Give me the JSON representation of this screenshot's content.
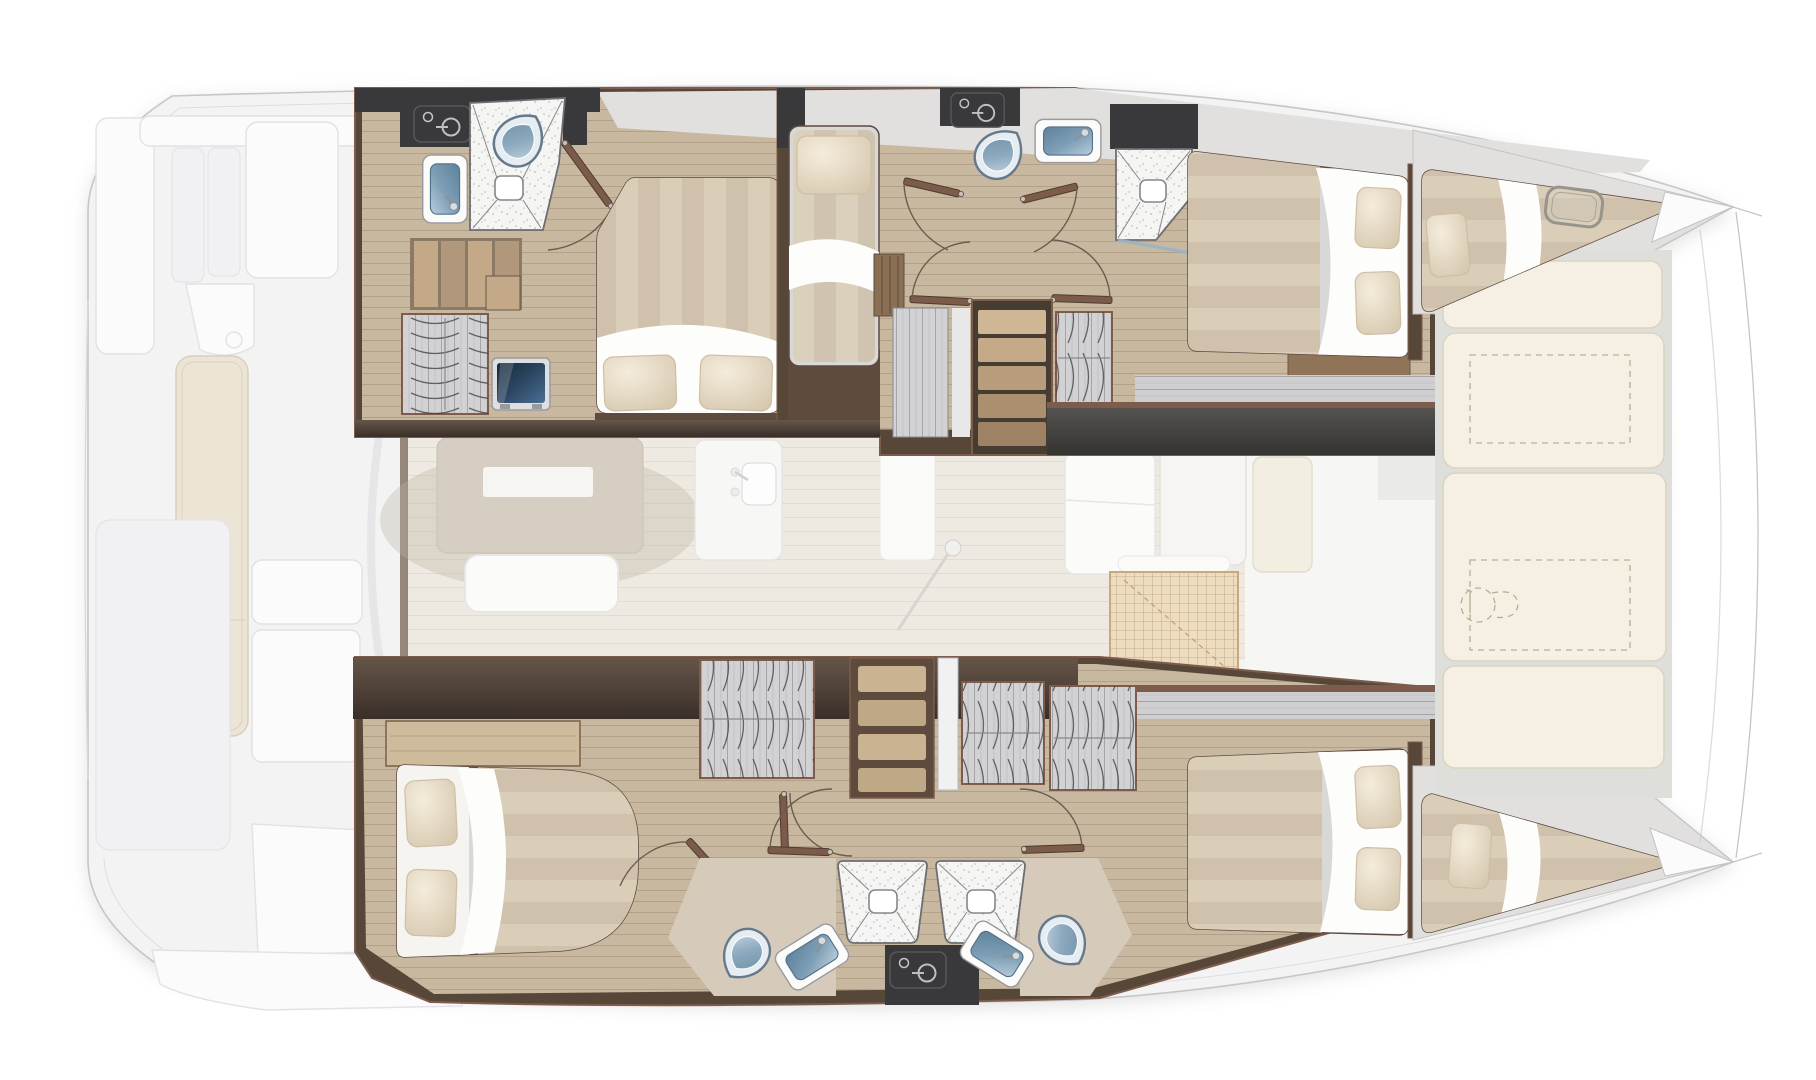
{
  "meta": {
    "title": "Sailing catamaran interior floor plan",
    "view": "top-down deck plan",
    "bow_direction": "right",
    "stern_direction": "left",
    "visible_text": []
  },
  "palette": {
    "hull_outline": "#c6c6c9",
    "gunwale": "#dddde0",
    "deck_ghost": "#f3f3f4",
    "panel_white": "#fbfbfc",
    "panel_stroke": "#e2e2e5",
    "cushion_cream": "#ece4d4",
    "cushion_stroke": "#d9cfbc",
    "wall_brown": "#574739",
    "wall_trim": "#7d5c4b",
    "charcoal": "#39393b",
    "wood_floor": "#c9b8a0",
    "wood_line": "#b2a089",
    "wood_light": "#cdbb9b",
    "marble": "#e1e0de",
    "saloon_floor": "#efeae1",
    "saloon_line": "#e2dcd0",
    "table_taupe": "#d6cec2",
    "bed_base": "#d8d8d6",
    "stripe_light": "#dbceb8",
    "stripe_dark": "#cfc1ab",
    "sheet_white": "#fdfdfc",
    "pillow_light": "#f0e6d3",
    "pillow_dark": "#d7c9b0",
    "pillow_stroke": "#cdbfa6",
    "wardrobe_gray": "#d2d2d4",
    "wardrobe_streak": "#a5a5a9",
    "arc_dark": "#454545",
    "shelf_brown": "#5e4b3e",
    "shelf_wood": "#c9b390",
    "step_wood": "#c3a987",
    "shower_white": "#f5f5f3",
    "shower_line": "#87878b",
    "shower_frame": "#6e6e72",
    "fixture_blue_deep": "#54718a",
    "fixture_blue": "#6e93ad",
    "fixture_blue_light": "#b3cbdb",
    "toilet_body": "#e6edf2",
    "toilet_stroke": "#66798a",
    "tv_dark": "#1e3147",
    "tv_light": "#456a90",
    "sunpad": "#f5f0e3",
    "sunpad_stroke": "#dcd4bf",
    "sunpad_dash": "#b8ae95",
    "grid_tan": "#eddcc0",
    "grid_line": "#b99e77",
    "door_leaf": "#7b5b49",
    "arc_line": "#6b5c51"
  },
  "layout_inventory": {
    "aft_deck": {
      "label": "aft cockpit deck (ghosted)",
      "items": [
        "swim-platform",
        "cockpit-bench-cushion",
        "cockpit-table",
        "deck-lockers",
        "deck-panels"
      ]
    },
    "port_hull": {
      "label": "port hull (top of plan)",
      "rooms": [
        {
          "name": "aft-bathroom",
          "furniture": [
            "toilet",
            "shower-stall",
            "washbasin",
            "power-panel"
          ]
        },
        {
          "name": "aft-cabin",
          "furniture": [
            "double-berth",
            "pillows",
            "access-steps",
            "hanging-locker",
            "tv-screen",
            "nightstand"
          ]
        },
        {
          "name": "companionway-berth",
          "furniture": [
            "single-berth",
            "pillow",
            "foot-locker"
          ]
        },
        {
          "name": "day-head",
          "furniture": [
            "toilet",
            "washbasin",
            "power-panel"
          ]
        },
        {
          "name": "shower-room",
          "furniture": [
            "shower-stall",
            "glass-door"
          ]
        },
        {
          "name": "companionway",
          "furniture": [
            "stairs",
            "hanging-locker",
            "cabin-doors"
          ]
        },
        {
          "name": "forward-cabin",
          "furniture": [
            "double-berth",
            "pillows"
          ]
        },
        {
          "name": "forepeak",
          "furniture": [
            "single-berth",
            "pillow",
            "deck-hatch"
          ]
        }
      ]
    },
    "saloon": {
      "label": "bridgedeck saloon (ghosted)",
      "items": [
        "saloon-table",
        "sofa",
        "galley-sink",
        "galley-cabinets",
        "refrigerator",
        "floor-grating",
        "compass-ball",
        "sliding-door-track"
      ]
    },
    "starboard_hull": {
      "label": "starboard hull (bottom of plan)",
      "rooms": [
        {
          "name": "aft-cabin",
          "furniture": [
            "double-berth",
            "pillows",
            "hanging-locker",
            "shelf-unit"
          ]
        },
        {
          "name": "corridor",
          "furniture": [
            "hanging-locker",
            "hanging-locker",
            "cabin-doors"
          ]
        },
        {
          "name": "bathroom-port-side",
          "furniture": [
            "toilet",
            "washbasin",
            "shower-stall"
          ]
        },
        {
          "name": "bathroom-starboard-side",
          "furniture": [
            "toilet",
            "washbasin",
            "shower-stall",
            "power-panel"
          ]
        },
        {
          "name": "forward-cabin",
          "furniture": [
            "double-berth",
            "pillows"
          ]
        },
        {
          "name": "forepeak",
          "furniture": [
            "single-berth",
            "pillow"
          ]
        }
      ]
    },
    "foredeck": {
      "label": "foredeck between bows",
      "items": [
        "sunpad-cushions",
        "optional-equipment-dashed-outline",
        "optional-toilet-dashed-outline",
        "bow-bridle-lines"
      ]
    }
  }
}
